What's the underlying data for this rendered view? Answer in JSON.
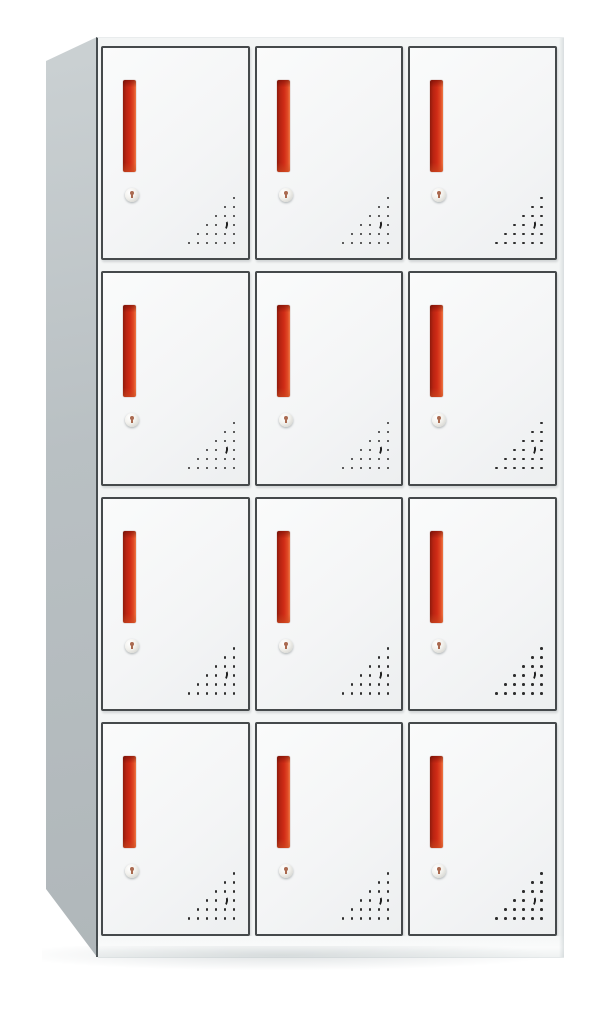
{
  "meta": {
    "type": "product-photo",
    "subject": "12-door steel locker cabinet",
    "view": "front three-quarter view, left side visible",
    "visible_text": ""
  },
  "scene": {
    "background_color": "#ffffff",
    "width_px": 605,
    "height_px": 1009
  },
  "cabinet": {
    "rows": 4,
    "columns": 3,
    "door_count": 12,
    "body_color": "#f3f5f5",
    "side_panel_color": "#b9c0c3",
    "plinth_color": "#fafbfb",
    "door": {
      "face_color": "#f4f5f6",
      "border_color": "#45494b",
      "handle": {
        "type": "recessed-vertical-handle",
        "primary_color": "#d02c16",
        "shadow_color": "#8f1b0c",
        "highlight_color": "#ee7845"
      },
      "lock": {
        "type": "cam-keyhole-lock",
        "body_color": "#e3e3df",
        "keyhole_color": "#aa6a50"
      },
      "vents": {
        "type": "perforation-triangle",
        "rows": [
          1,
          2,
          3,
          4,
          5,
          6
        ],
        "dot_color": "#2d2d2d",
        "crescent_row": 4,
        "crescent_col_from_right": 2
      }
    }
  }
}
